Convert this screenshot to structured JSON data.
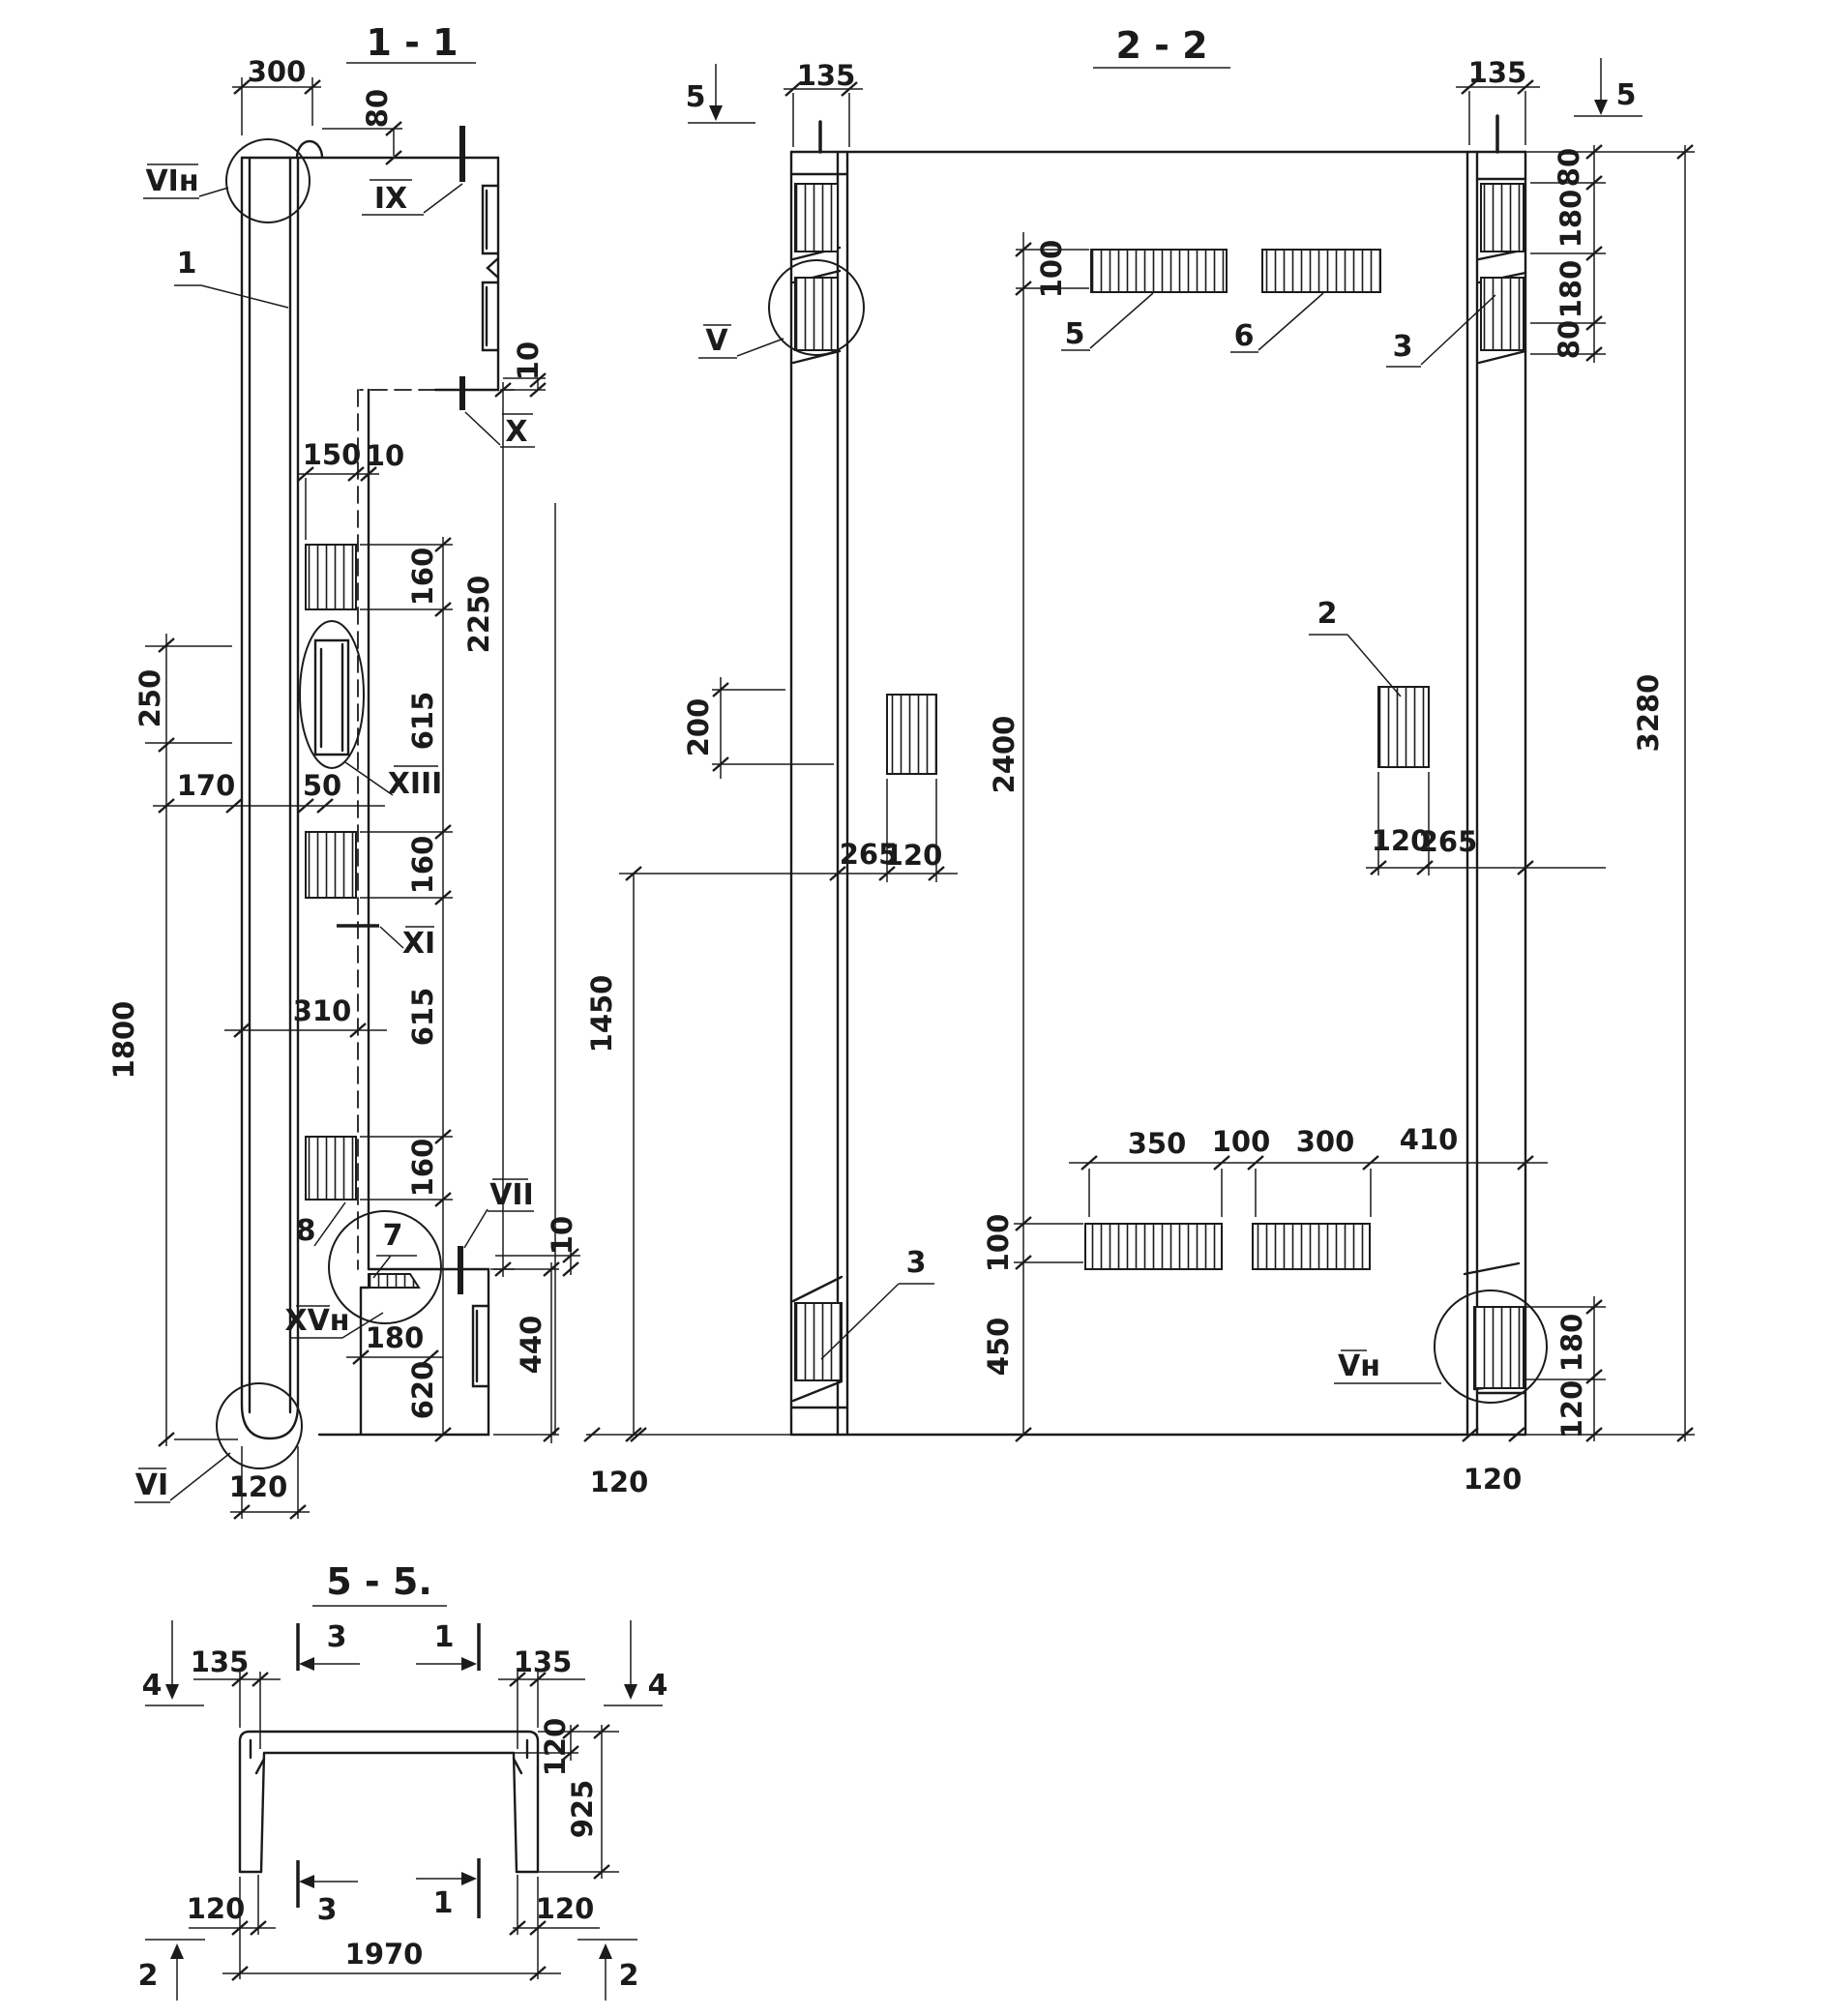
{
  "drawing": {
    "bg": "#ffffff",
    "ink": "#1b1b1b",
    "s11": {
      "title": "1 - 1",
      "labels": {
        "vi_n": "VIн",
        "ix": "IX",
        "n1": "1",
        "x": "X",
        "xiii": "XIII",
        "xi": "XI",
        "n8": "8",
        "n7": "7",
        "xv_n": "XVн",
        "vii": "VII",
        "vi": "VI"
      },
      "dims": {
        "d300": "300",
        "d80": "80",
        "d10a": "10",
        "d150": "150",
        "d10b": "10",
        "d160a": "160",
        "d615a": "615",
        "d160b": "160",
        "d615b": "615",
        "d160c": "160",
        "d620": "620",
        "d2250": "2250",
        "d250": "250",
        "d1800": "1800",
        "d170": "170",
        "d50": "50",
        "d310": "310",
        "d180": "180",
        "d440": "440",
        "d10c": "10",
        "d120": "120"
      }
    },
    "s22": {
      "title": "2 - 2",
      "labels": {
        "v": "V",
        "n5": "5",
        "n6": "6",
        "n2": "2",
        "n3r": "3",
        "n3l": "3",
        "v_n": "Vн",
        "mark5l": "5",
        "mark5r": "5"
      },
      "dims": {
        "d135l": "135",
        "d135r": "135",
        "d80a": "80",
        "d180a": "180",
        "d180b": "180",
        "d80b": "80",
        "d3280": "3280",
        "d100t": "100",
        "d200": "200",
        "d2400": "2400",
        "d100b": "100",
        "d450": "450",
        "d265l": "265",
        "d120l": "120",
        "d120r": "120",
        "d265r": "265",
        "d1450": "1450",
        "d350": "350",
        "d100m": "100",
        "d300": "300",
        "d410": "410",
        "d180c": "180",
        "d120rb": "120",
        "d120bl": "120",
        "d120br": "120"
      }
    },
    "s55": {
      "title": "5 - 5.",
      "marks": {
        "m4l": "4",
        "m4r": "4",
        "m3t": "3",
        "m1t": "1",
        "m3b": "3",
        "m1b": "1",
        "m2l": "2",
        "m2r": "2"
      },
      "dims": {
        "d135l": "135",
        "d135r": "135",
        "d120t": "120",
        "d925": "925",
        "d120bl": "120",
        "d120br": "120",
        "d1970": "1970"
      }
    }
  }
}
